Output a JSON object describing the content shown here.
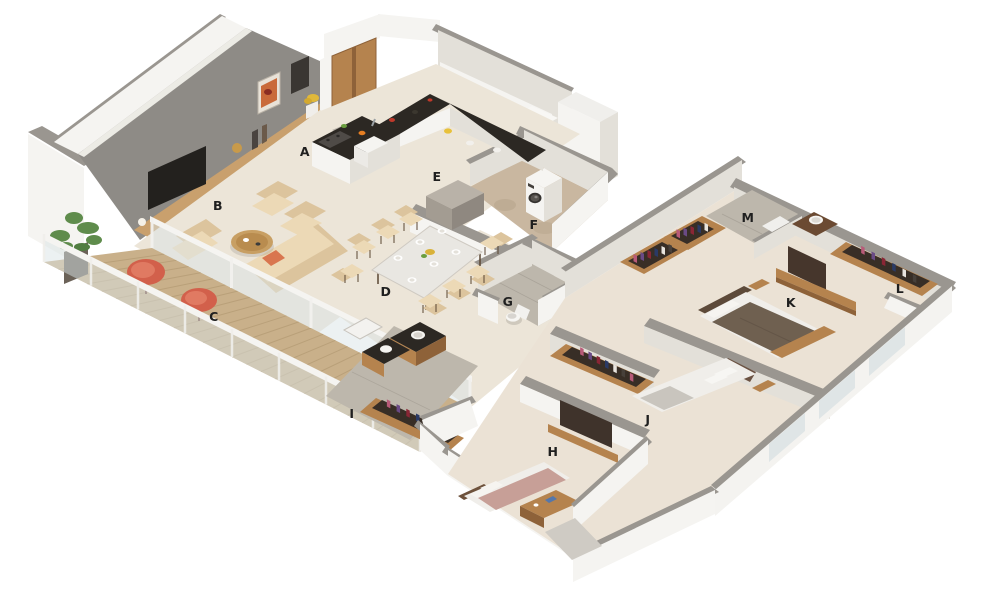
{
  "canvas": {
    "width": 1000,
    "height": 600,
    "background": "#ffffff"
  },
  "scene_kind": "isometric-3d-floor-plan",
  "room_labels": [
    {
      "id": "A",
      "x": 305,
      "y": 156
    },
    {
      "id": "B",
      "x": 218,
      "y": 210
    },
    {
      "id": "C",
      "x": 214,
      "y": 321
    },
    {
      "id": "D",
      "x": 386,
      "y": 296
    },
    {
      "id": "E",
      "x": 437,
      "y": 181
    },
    {
      "id": "F",
      "x": 534,
      "y": 229
    },
    {
      "id": "G",
      "x": 508,
      "y": 306
    },
    {
      "id": "H",
      "x": 553,
      "y": 456
    },
    {
      "id": "I",
      "x": 352,
      "y": 418
    },
    {
      "id": "J",
      "x": 648,
      "y": 424
    },
    {
      "id": "K",
      "x": 791,
      "y": 307
    },
    {
      "id": "L",
      "x": 900,
      "y": 293
    },
    {
      "id": "M",
      "x": 748,
      "y": 222
    }
  ],
  "palette": {
    "background": "#ffffff",
    "floor": "#ece5d8",
    "floorBed": "#ebe2d5",
    "floorGray": "#bdb7ac",
    "floorTan": "#c9b7a0",
    "deck": "#c9b08a",
    "deckLine": "#a68d66",
    "wallCap": "#9a9690",
    "wallLit": "#f5f4f1",
    "wallShade": "#e3e0d9",
    "wallGray": "#8e8b86",
    "wood": "#b5834e",
    "woodDark": "#8e6239",
    "woodLight": "#c9a06d",
    "counter": "#2c2823",
    "beige": "#ecd9b6",
    "beigeDark": "#dcc49d",
    "glass": "#d9e3e5",
    "red": "#d2604b",
    "redLight": "#e07a62",
    "green": "#517d41",
    "blanket": "#6f6050",
    "bedWhite": "#f0eeea",
    "bedPink": "#c79f97",
    "darkPanel": "#3f332b",
    "tv": "#23211e",
    "label": "#1f1f1f",
    "clothes": [
      "#b85a78",
      "#6a4a85",
      "#8a2635",
      "#2a3a66",
      "#e8e4de",
      "#47403a"
    ]
  }
}
